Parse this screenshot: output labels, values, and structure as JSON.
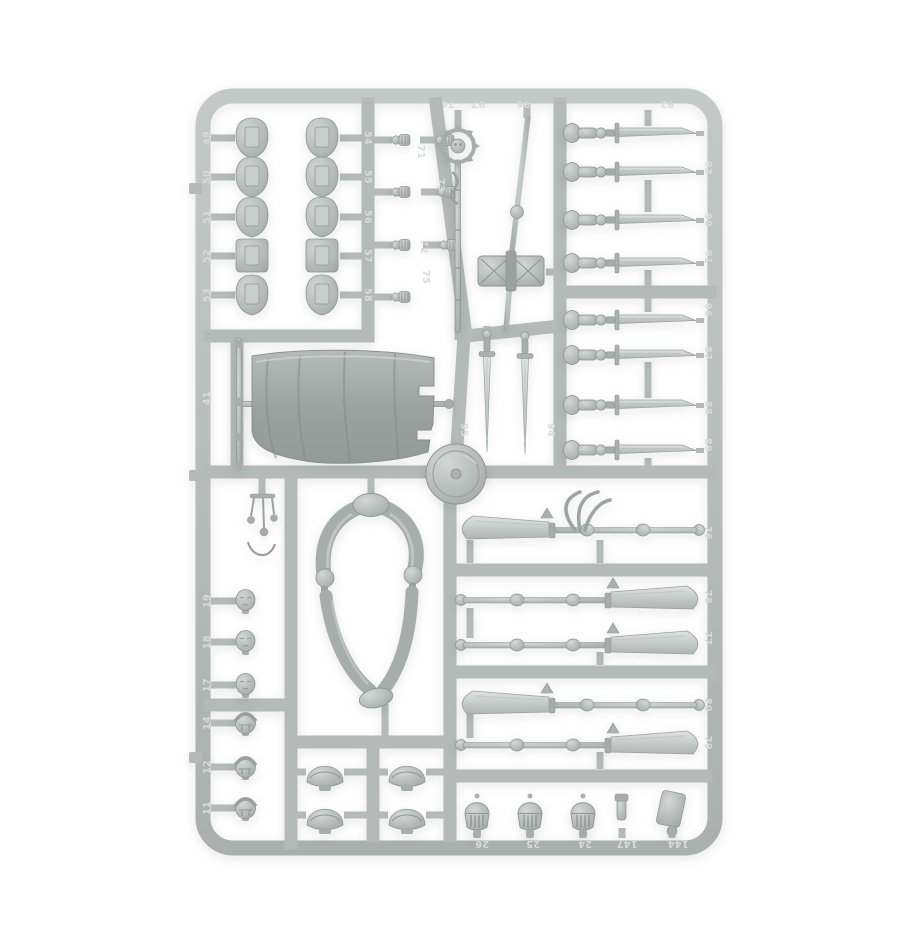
{
  "photo": {
    "description": "Product photograph of a light grey plastic miniatures sprue (model kit frame) on a white background, filled with armour parts, swords, glaives, heads, helmets, a banner and leg assemblies",
    "background_color": "#ffffff"
  },
  "colors": {
    "sprue_rail": "#b6bdbb",
    "runner": "#b3bab8",
    "part_light": "#d3d8d6",
    "part_dark": "#a2a9a7",
    "blade_light": "#dfe3e1",
    "cloth_dark": "#939b99",
    "embossed_number": "#d7dcda"
  },
  "part_numbers": {
    "top_rail": [
      "74",
      "97",
      "96",
      "92"
    ],
    "right_rail": [
      "93",
      "90",
      "91",
      "96",
      "87",
      "88",
      "89",
      "76",
      "78",
      "77",
      "80",
      "79"
    ],
    "bottom_rail": [
      "26",
      "25",
      "24",
      "147",
      "144"
    ],
    "left_rail_top": [
      "49",
      "50",
      "51",
      "52",
      "53"
    ],
    "left_rail_mid": [
      "41"
    ],
    "left_rail_lower": [
      "19",
      "18",
      "17",
      "14",
      "12",
      "11"
    ],
    "pad_runner": [
      "54",
      "55",
      "56",
      "57",
      "58"
    ],
    "hand_runner": [
      "71",
      "72",
      "75"
    ],
    "staff_runner": [
      "73"
    ],
    "sword_runner": [
      "95",
      "94"
    ]
  },
  "part_counts": {
    "shoulder_pads": 10,
    "hands": 7,
    "bare_heads": 3,
    "helmeted_heads": 3,
    "great_helms": 3,
    "sword_arm_assemblies": 8,
    "hanging_swords": 2,
    "glaives": 5,
    "pauldrons": 4,
    "banner": 1,
    "legs_assembly": 1,
    "round_shield": 1,
    "warhammer": 1,
    "skull_staff": 1
  }
}
